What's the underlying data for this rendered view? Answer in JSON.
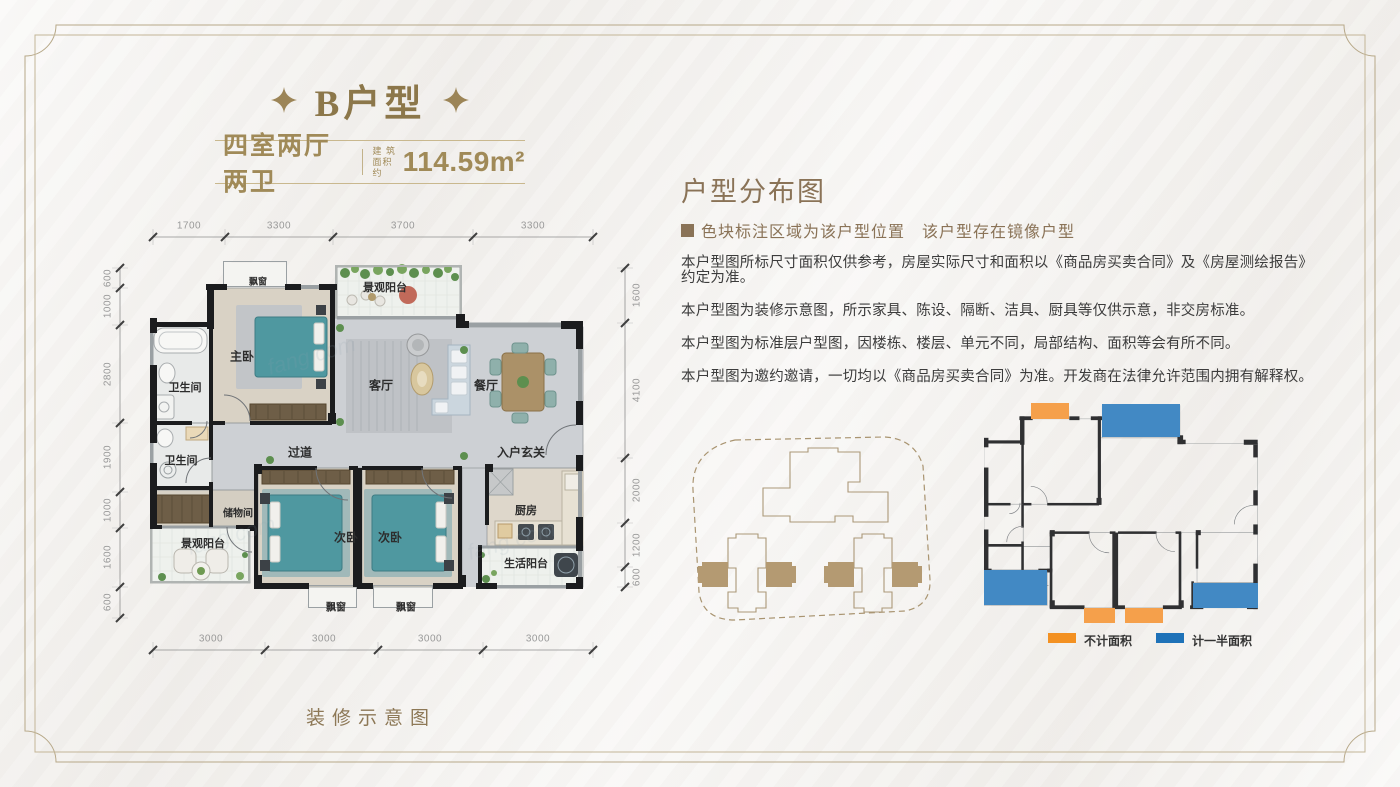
{
  "header": {
    "title": "B户型",
    "unit_type": "四室两厅两卫",
    "area_label_line1": "建 筑",
    "area_label_line2": "面积约",
    "area_value": "114.59m²"
  },
  "floor_plan": {
    "caption": "装修示意图",
    "watermark": "fang.com",
    "dims_top": [
      "1700",
      "3300",
      "3700",
      "3300"
    ],
    "dims_left": [
      "600",
      "1000",
      "2800",
      "1900",
      "1000",
      "1600",
      "600"
    ],
    "dims_right": [
      "1600",
      "4100",
      "2000",
      "1200",
      "600"
    ],
    "dims_bottom": [
      "3000",
      "3000",
      "3000",
      "3000"
    ],
    "rooms": {
      "bay_top": "飘窗",
      "balcony_top": "景观阳台",
      "master": "主卧",
      "bath_upper": "卫生间",
      "living": "客厅",
      "dining": "餐厅",
      "corridor": "过道",
      "foyer": "入户玄关",
      "bath_lower": "卫生间",
      "storage": "储物间",
      "balcony_lower": "景观阳台",
      "bed_left": "次卧",
      "bed_right": "次卧",
      "kitchen": "厨房",
      "utility_balcony": "生活阳台",
      "bay_bottom_left": "飘窗",
      "bay_bottom_right": "飘窗"
    }
  },
  "distribution": {
    "heading": "户型分布图",
    "note": "色块标注区域为该户型位置　该户型存在镜像户型",
    "disclaimers": [
      "本户型图所标尺寸面积仅供参考，房屋实际尺寸和面积以《商品房买卖合同》及《房屋测绘报告》约定为准。",
      "本户型图为装修示意图，所示家具、陈设、隔断、洁具、厨具等仅供示意，非交房标准。",
      "本户型图为标准层户型图，因楼栋、楼层、单元不同，局部结构、面积等会有所不同。",
      "本户型图为邀约邀请，一切均以《商品房买卖合同》为准。开发商在法律允许范围内拥有解释权。"
    ],
    "legend": [
      {
        "label": "不计面积",
        "color": "#f39122"
      },
      {
        "label": "计一半面积",
        "color": "#1e72b8"
      }
    ]
  },
  "colors": {
    "accent_gold": "#97804f",
    "heading_brown": "#8a7357",
    "block_orange": "#f5a04b",
    "block_blue": "#4289c4"
  }
}
